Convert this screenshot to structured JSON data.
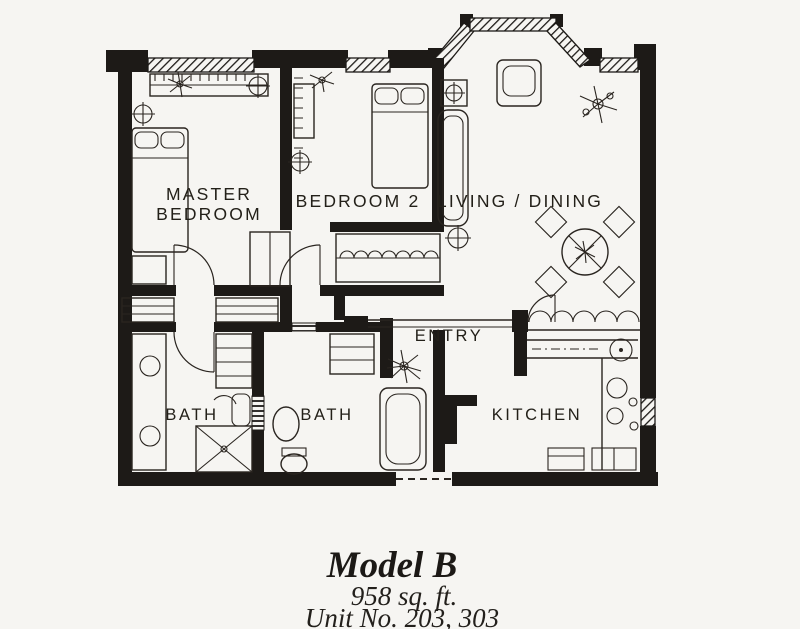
{
  "title": "Model B floor plan",
  "colors": {
    "paper": "#f6f5f2",
    "ink": "#1d1a17",
    "line": "#2a2520"
  },
  "rooms": {
    "master": {
      "line1": "MASTER",
      "line2": "BEDROOM"
    },
    "bedroom2": {
      "label": "BEDROOM 2"
    },
    "living": {
      "label": "LIVING / DINING"
    },
    "entry": {
      "label": "ENTRY"
    },
    "kitchen": {
      "label": "KITCHEN"
    },
    "bath_left": {
      "label": "BATH"
    },
    "bath_right": {
      "label": "BATH"
    }
  },
  "caption": {
    "model": "Model B",
    "area": "958 sq. ft.",
    "unit": "Unit No. 203, 303"
  }
}
